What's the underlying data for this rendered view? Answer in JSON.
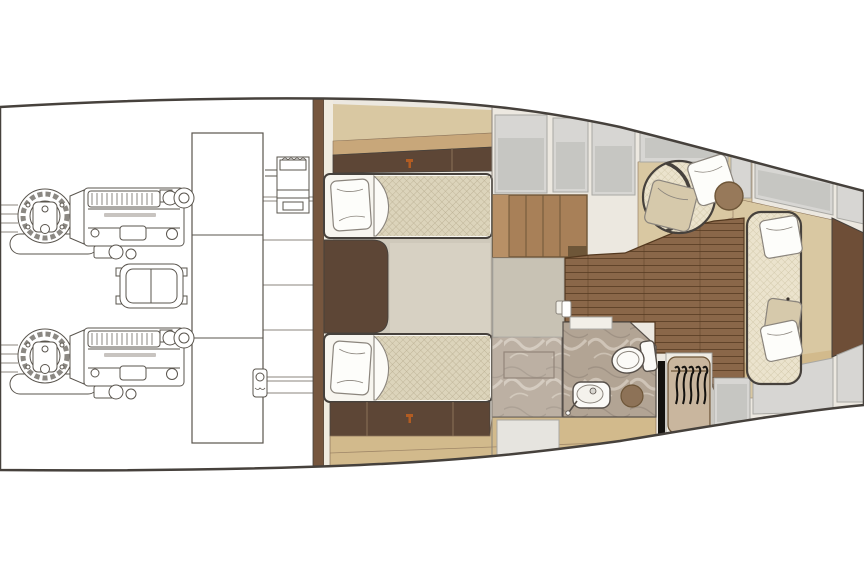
{
  "diagram": {
    "type": "yacht-interior-floor-plan",
    "view": "top-down",
    "bow_direction": "right",
    "text_visible": "none",
    "rooms": [
      {
        "name": "engine-room",
        "items": [
          "port-engine",
          "starboard-engine",
          "fuel-tank",
          "muffler",
          "generator",
          "bilge-pump"
        ]
      },
      {
        "name": "twin-cabin",
        "items": [
          "bed-port",
          "bed-starboard",
          "overhead-cabinet",
          "lower-cabinet",
          "nightstand",
          "carpet",
          "marble-vanity"
        ]
      },
      {
        "name": "corridor",
        "items": [
          "companionway-steps",
          "entry-floor",
          "lockers"
        ]
      },
      {
        "name": "bathroom",
        "items": [
          "toilet",
          "sink",
          "stool",
          "marble-floor",
          "door"
        ]
      },
      {
        "name": "bow-lounge",
        "items": [
          "armchair",
          "side-table",
          "sofa",
          "wardrobe",
          "bow-berth-panel",
          "deck-panels",
          "wood-floor"
        ]
      }
    ],
    "counts": {
      "engines": 2,
      "beds": 2,
      "pillows": 7,
      "hangers": 5,
      "deck_panels_top": 7,
      "deck_panels_bottom": 3,
      "accent_marks": 2
    }
  },
  "palette": {
    "outline": "#46413c",
    "line": "#5a554e",
    "thin_line": "#8b857d",
    "paper": "#ffffff",
    "interior": "#ece8e0",
    "bulkhead": "#76563e",
    "wall": "#f0ebdf",
    "cabinet_dark": "#5d4636",
    "cabinet_divider": "#8a7258",
    "tan": "#d9c8a2",
    "tan_deep": "#d2ba8c",
    "shelf_wood": "#c8a77a",
    "wood_floor": "#8a6749",
    "wood_line": "#53381f",
    "steps": "#a88058",
    "steps_light": "#b89066",
    "steps_dark": "#6e5638",
    "gray_panel": "#d7d6d3",
    "gray_panel_inner": "#c6c6c2",
    "gray_edge": "#a9a8a3",
    "carpet": "#cfc9bb",
    "carpet_light": "#d8d2c4",
    "entry_floor": "#c8c2b4",
    "mattress": "#dcd4bb",
    "mattress_line": "#b9ae91",
    "upholstery": "#ebe3cd",
    "upholstery_line": "#cfc5a6",
    "pillow_white": "#fdfdfa",
    "pillow_beige": "#d6c9ab",
    "marble": "#b2a494",
    "marble_vein_light": "#d6ccbf",
    "marble_vein_dark": "#93857a",
    "fixture_white": "#fbfaf7",
    "fixture_line": "#57504a",
    "stool": "#8d7257",
    "wardrobe_panel": "#c9b69e",
    "wardrobe_light": "#d6c5ab",
    "table_brown": "#97795a",
    "wedge_brown": "#6e4e37",
    "accent_orange": "#b25c22",
    "black": "#14120f",
    "door_panel": "#e6e4df"
  }
}
